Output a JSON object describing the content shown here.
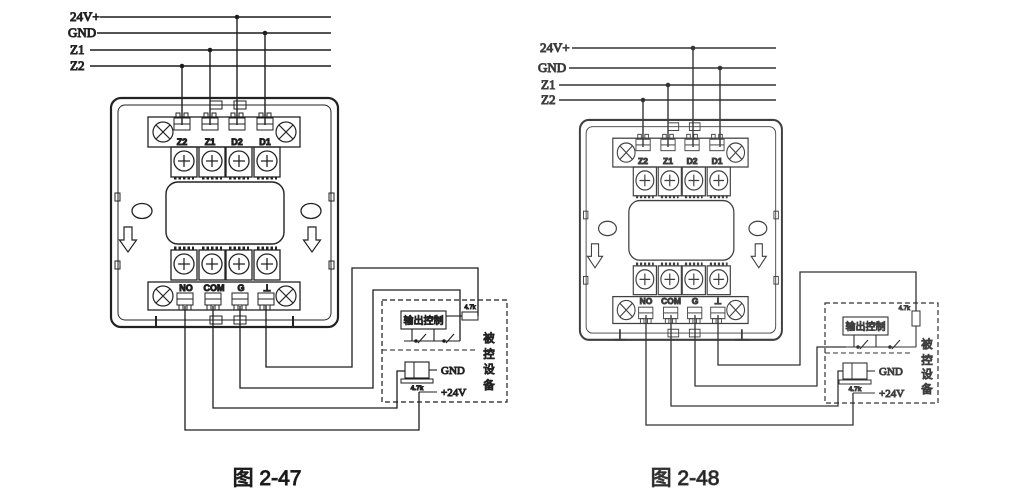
{
  "diagrams": [
    {
      "caption": "图 2-47"
    },
    {
      "caption": "图 2-48"
    }
  ],
  "bus_labels": [
    "24V+",
    "GND",
    "Z1",
    "Z2"
  ],
  "terminals": {
    "top": [
      "Z2",
      "Z1",
      "D2",
      "D1"
    ],
    "bottom": [
      "NO",
      "COM",
      "G",
      "⊥"
    ]
  },
  "device_box": {
    "control_label": "输出控制",
    "eol_resistor": "4.7k",
    "input_resistor": "4.7k",
    "gnd": "GND",
    "power": "+24V",
    "device_name_chars": [
      "被",
      "控",
      "设",
      "备"
    ]
  },
  "colors": {
    "line_left": "#222222",
    "line_right": "#3f3f3f",
    "background": "#ffffff"
  }
}
